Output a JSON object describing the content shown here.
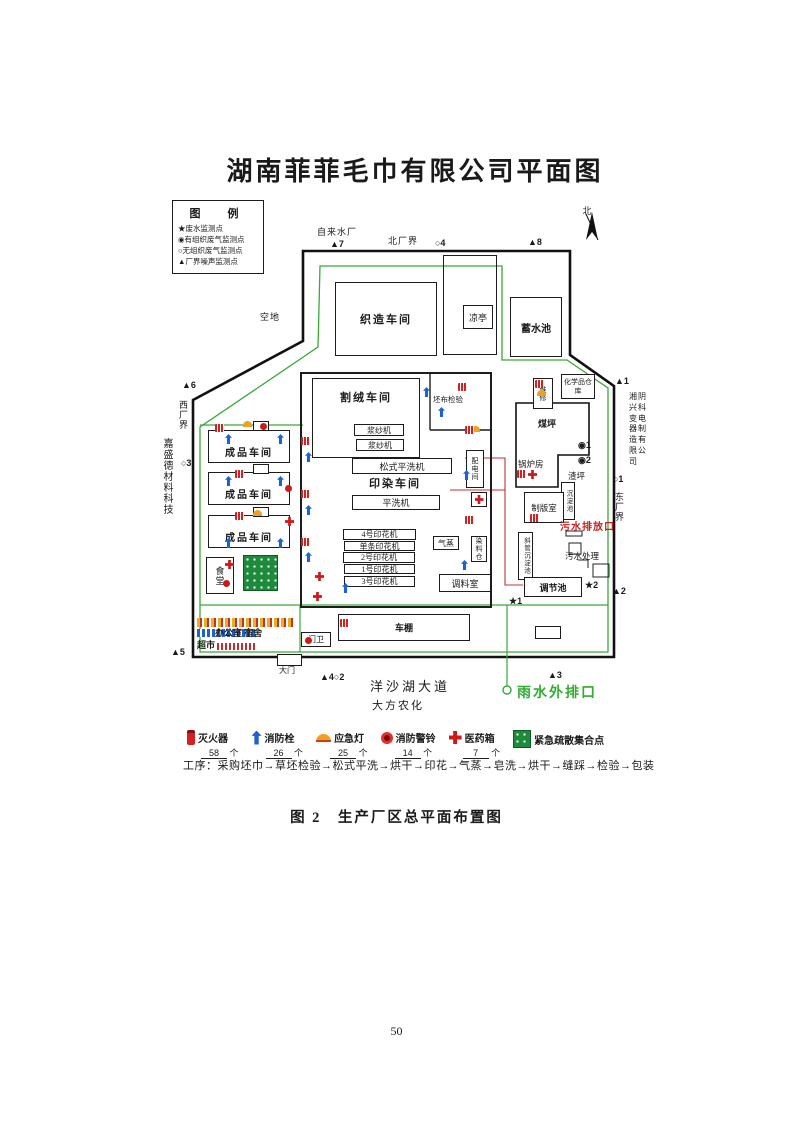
{
  "page": {
    "number": "50",
    "caption": "图 2　生产厂区总平面布置图"
  },
  "diagram": {
    "title": "湖南菲菲毛巾有限公司平面图",
    "legend": {
      "title": "图　例",
      "items": [
        {
          "symbol": "★",
          "label": "废水监测点"
        },
        {
          "symbol": "◉",
          "label": "有组织废气监测点"
        },
        {
          "symbol": "○",
          "label": "无组织废气监测点"
        },
        {
          "symbol": "▲",
          "label": "厂界噪声监测点"
        }
      ]
    },
    "compass": "北",
    "surroundings": {
      "water_plant": "自来水厂",
      "north_boundary": "北厂界",
      "west_boundary": "西厂界",
      "east_boundary": "东厂界",
      "west_neighbor": "嘉盛德材料科技",
      "east_neighbor": "湘阴兴科变电器制造有限公司",
      "south_road": "洋沙湖大道",
      "south_neighbor": "大方农化",
      "open_land": "空地"
    },
    "buildings": {
      "weaving": "织造车间",
      "pavilion": "凉亭",
      "reservoir": "蓄水池",
      "cutting": "割绒车间",
      "fabric_inspection": "坯布检验",
      "sizing1": "浆纱机",
      "sizing2": "浆纱机",
      "loose_wash": "松式平洗机",
      "dye_workshop": "印染车间",
      "flat_wash": "平洗机",
      "print4": "4号印花机",
      "print_single": "单条印花机",
      "print2": "2号印花机",
      "print1": "1号印花机",
      "print3": "3号印花机",
      "steam": "气蒸",
      "dye_store": "染料仓",
      "mixing_room": "调料室",
      "power_room": "配电间",
      "maintenance": "维修",
      "chem_store": "化学品仓库",
      "coal_yard": "煤坪",
      "boiler": "锅炉房",
      "slag_yard": "渣坪",
      "sediment": "沉淀池",
      "plate_room": "制版室",
      "inclined_sediment": "斜管沉淀池",
      "sewage_treatment": "污水处理",
      "regulating_pool": "调节池",
      "finished1": "成品车间",
      "finished2": "成品车间",
      "finished3": "成品车间",
      "canteen": "食堂",
      "market": "超市",
      "office_dorm": "办公室 宿舍",
      "guard": "门卫",
      "bike_shed": "车棚",
      "gate": "大门"
    },
    "markers": {
      "n1": "▲1",
      "n2": "▲2",
      "n3": "▲3",
      "n4": "▲4○2",
      "n5": "▲5",
      "n6": "▲6",
      "n7": "▲7",
      "n8": "▲8",
      "o1": "○1",
      "o3": "○3",
      "o4": "○4",
      "g1": "◉1",
      "g2": "◉2",
      "w1": "★1",
      "w2": "★2"
    },
    "outfalls": {
      "sewage": "污水排放口",
      "rain": "雨水外排口"
    },
    "safety_legend": {
      "unit": "个",
      "items": [
        {
          "name": "灭火器",
          "count": "58"
        },
        {
          "name": "消防栓",
          "count": "26"
        },
        {
          "name": "应急灯",
          "count": "25"
        },
        {
          "name": "消防警铃",
          "count": "14"
        },
        {
          "name": "医药箱",
          "count": "7"
        },
        {
          "name": "紧急疏散集合点",
          "count": ""
        }
      ]
    },
    "process": "工序：采购坯巾→草坯检验→松式平洗→烘干→印花→气蒸→皂洗→烘干→缝踩→检验→包装"
  },
  "colors": {
    "boundary": "#111111",
    "site_line": "#3aa83a",
    "pipe": "#c43030",
    "rain_text": "#2fae2f",
    "sewage_text": "#c42222"
  }
}
